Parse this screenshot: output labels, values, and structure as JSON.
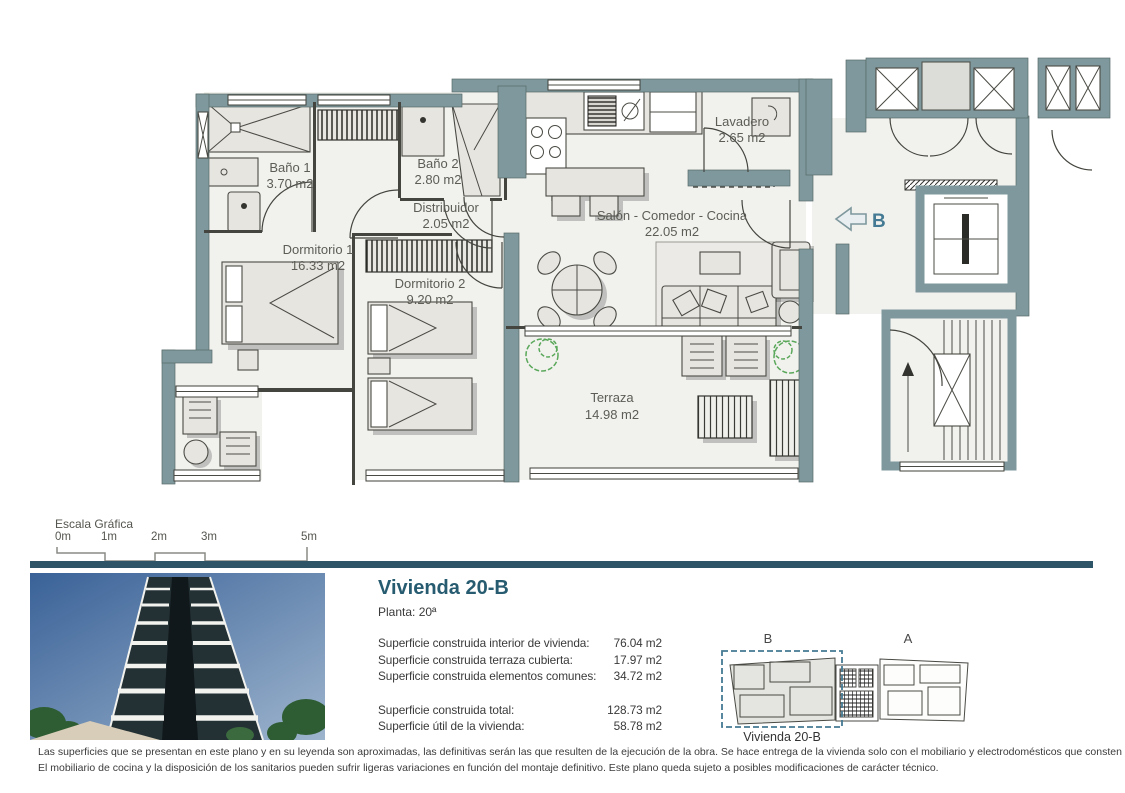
{
  "plan": {
    "rooms": [
      {
        "name": "Baño 1",
        "area": "3.70 m2"
      },
      {
        "name": "Baño 2",
        "area": "2.80 m2"
      },
      {
        "name": "Distribuidor",
        "area": "2.05 m2"
      },
      {
        "name": "Lavadero",
        "area": "2.65 m2"
      },
      {
        "name": "Salón - Comedor - Cocina",
        "area": "22.05 m2"
      },
      {
        "name": "Dormitorio 1",
        "area": "16.33 m2"
      },
      {
        "name": "Dormitorio 2",
        "area": "9.20 m2"
      },
      {
        "name": "Terraza",
        "area": "14.98 m2"
      }
    ],
    "unit_marker": "B"
  },
  "scale": {
    "title": "Escala Gráfica",
    "ticks": [
      "0m",
      "1m",
      "2m",
      "3m",
      "5m"
    ]
  },
  "info": {
    "title": "Vivienda 20-B",
    "floor": "Planta: 20ª",
    "rows": [
      {
        "label": "Superficie construida interior de vivienda:",
        "value": "76.04 m2"
      },
      {
        "label": "Superficie construida terraza cubierta:",
        "value": "17.97 m2"
      },
      {
        "label": "Superficie construida elementos comunes:",
        "value": "34.72 m2"
      }
    ],
    "totals": [
      {
        "label": "Superficie construida total:",
        "value": "128.73 m2"
      },
      {
        "label": "Superficie útil de la vivienda:",
        "value": "58.78 m2"
      }
    ]
  },
  "keyplan": {
    "unit_b": "B",
    "unit_a": "A",
    "caption": "Vivienda 20-B"
  },
  "footer": {
    "line1": "Las superficies que se presentan en este plano y en su leyenda son aproximadas, las definitivas serán las que resulten de la ejecución de la obra. Se hace entrega de la vivienda solo con el mobiliario y electrodomésticos que consten en la memoria de calidades.",
    "line2": "El mobiliario de cocina y la disposición de los sanitarios pueden sufrir ligeras variaciones en función del montaje definitivo. Este plano queda sujeto a posibles modificaciones de carácter técnico."
  },
  "colors": {
    "wall": "#7E989D",
    "accent": "#265B70",
    "marker": "#447A93",
    "divider": "#2E5468"
  }
}
